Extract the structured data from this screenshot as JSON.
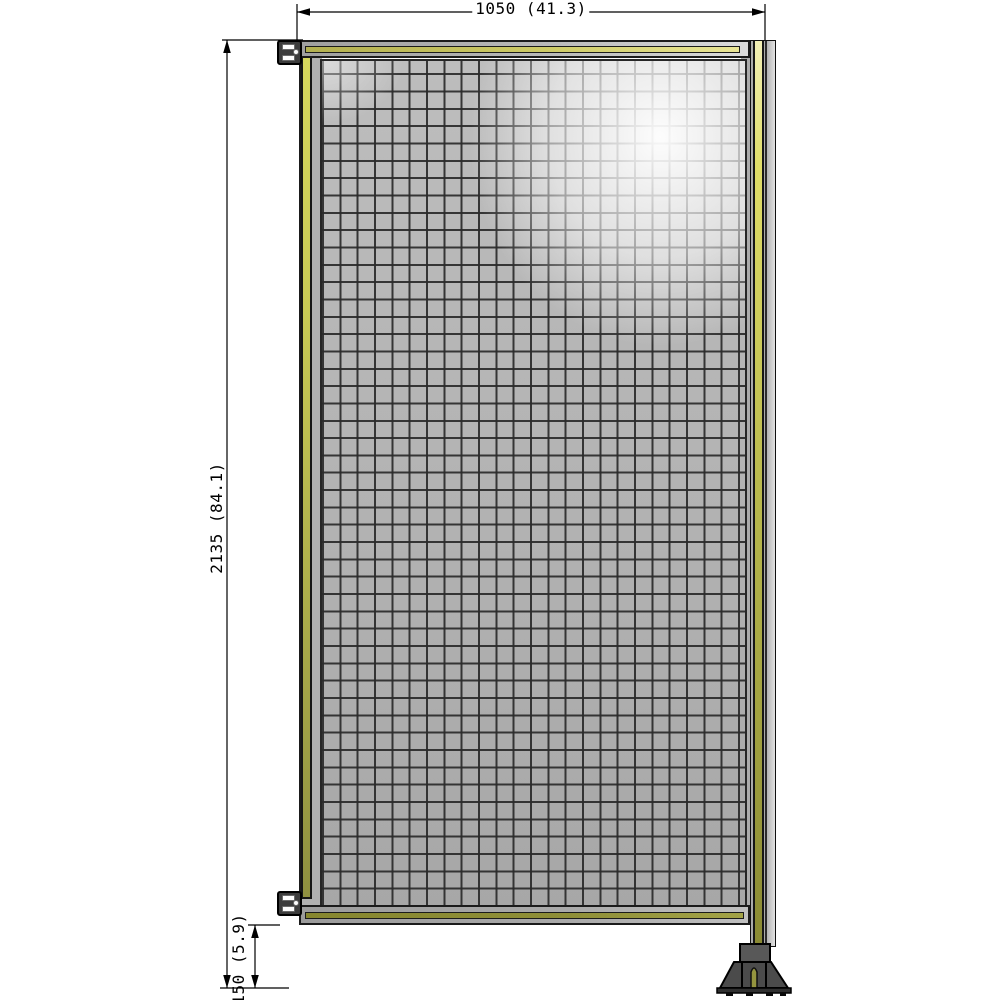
{
  "drawing": {
    "type": "technical-drawing",
    "subject": "wire mesh fence panel with mounting post and floor foot"
  },
  "dimensions": {
    "width_label": "1050 (41.3)",
    "height_label": "2135 (84.1)",
    "clearance_label": "150 (5.9)"
  },
  "colors": {
    "background": "#ffffff",
    "dimension_lines": "#000000",
    "frame_gray": "#ababab",
    "stripe_yellow_light": "#e9e596",
    "stripe_yellow": "#cdca66",
    "stripe_olive": "#8d8d38",
    "mesh_gray": "#b4b4b4",
    "mesh_grid_line": "#2a2a2a",
    "mesh_highlight": "#ffffff",
    "post_gray": "#d9d9d9",
    "foot_dark_gray": "#4b4b4b",
    "bracket_dark": "#3c3c3c"
  }
}
